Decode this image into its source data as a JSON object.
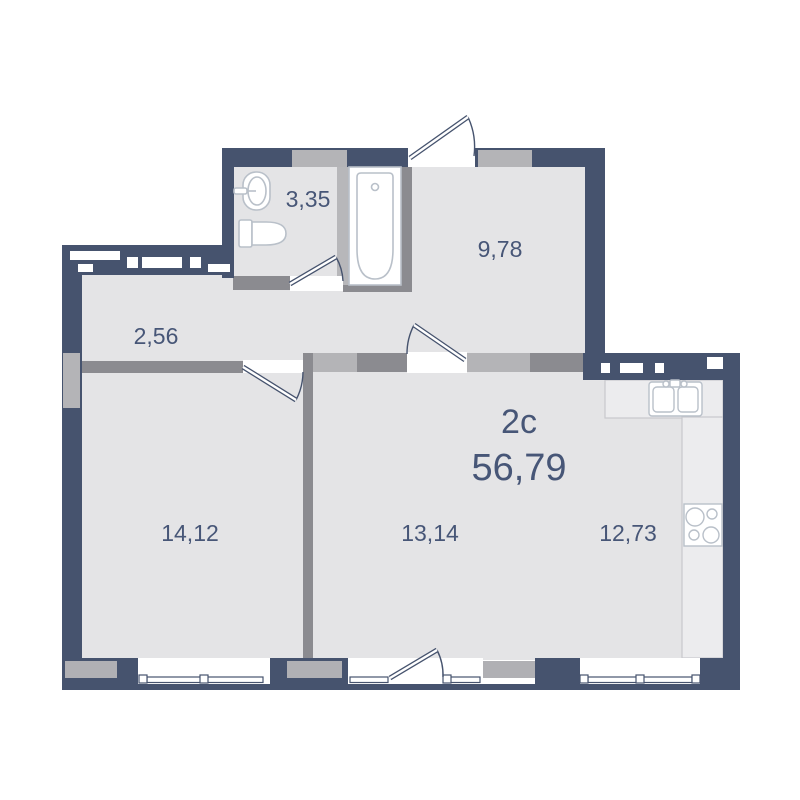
{
  "plan": {
    "type_label": "2c",
    "total_area": "56,79"
  },
  "rooms": [
    {
      "name": "bathroom",
      "area": "3,35"
    },
    {
      "name": "entrance-hall",
      "area": "9,78"
    },
    {
      "name": "corridor",
      "area": "2,56"
    },
    {
      "name": "bedroom",
      "area": "14,12"
    },
    {
      "name": "living-room",
      "area": "13,14"
    },
    {
      "name": "kitchen",
      "area": "12,73"
    }
  ],
  "fixtures": [
    "washbasin-icon",
    "toilet-icon",
    "bathtub-icon",
    "kitchen-sink-icon",
    "stove-icon"
  ],
  "colors": {
    "wall": "#46536e",
    "partition_dark": "#8b8b90",
    "partition_light": "#b4b4b7",
    "floor": "#e4e4e6",
    "fixture_outline": "#b9c0c9",
    "label_text": "#475677"
  }
}
